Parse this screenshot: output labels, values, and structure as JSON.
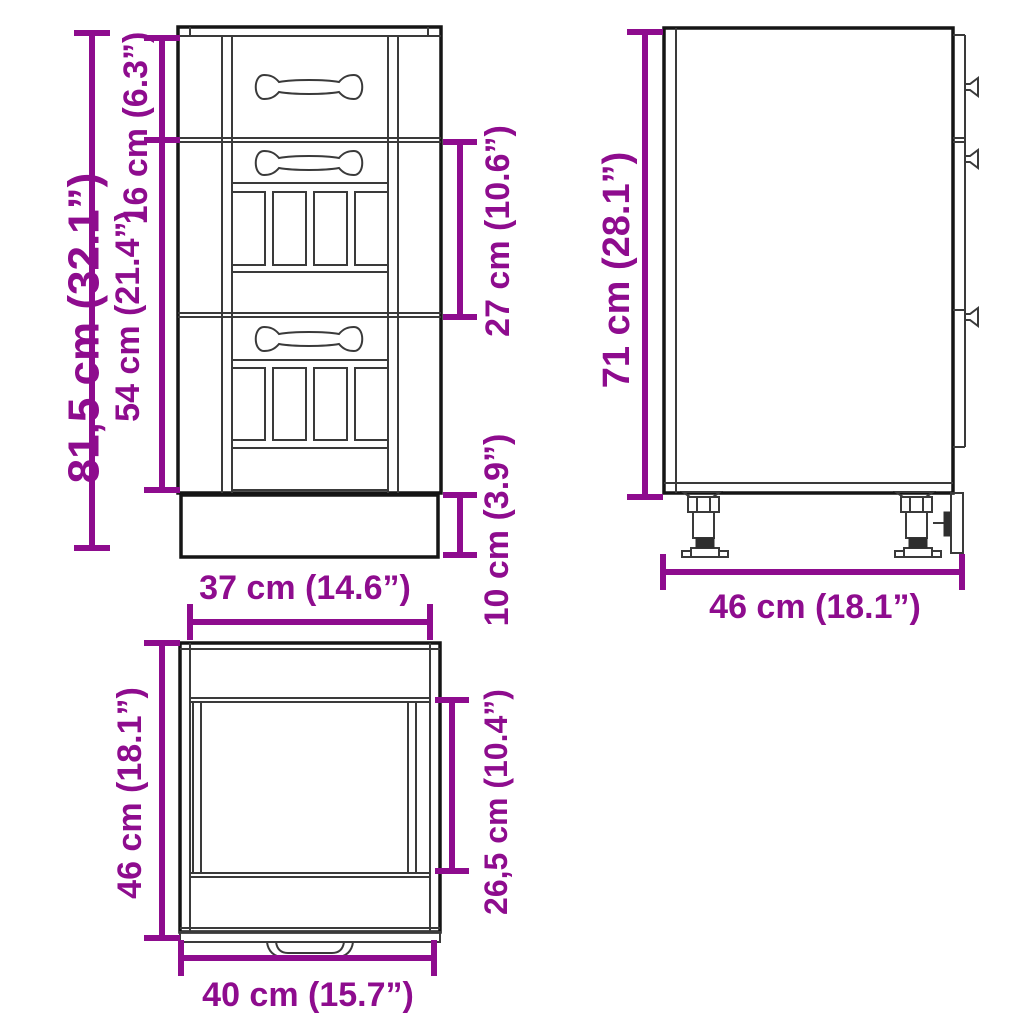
{
  "diagram": {
    "kind": "furniture-dimension-drawing",
    "subject": "kitchen base cabinet with drawers",
    "background_color": "#FFFFFF",
    "dimension_color": "#8E0C8E",
    "line_color": "#151515",
    "views": {
      "front": {
        "dimensions": {
          "total_height": {
            "label": "81,5 cm (32.1”)",
            "value_cm": "81,5",
            "value_in": "32.1"
          },
          "top_drawer_height": {
            "label": "16 cm (6.3”)",
            "value_cm": "16",
            "value_in": "6.3"
          },
          "lower_front_height": {
            "label": "54 cm (21.4”)",
            "value_cm": "54",
            "value_in": "21.4"
          },
          "middle_drawer_height": {
            "label": "27 cm (10.6”)",
            "value_cm": "27",
            "value_in": "10.6"
          },
          "plinth_height": {
            "label": "10 cm (3.9”)",
            "value_cm": "10",
            "value_in": "3.9"
          },
          "width": {
            "label": "37 cm (14.6”)",
            "value_cm": "37",
            "value_in": "14.6"
          }
        }
      },
      "side": {
        "dimensions": {
          "body_height": {
            "label": "71 cm (28.1”)",
            "value_cm": "71",
            "value_in": "28.1"
          },
          "depth": {
            "label": "46 cm (18.1”)",
            "value_cm": "46",
            "value_in": "18.1"
          }
        }
      },
      "top": {
        "dimensions": {
          "depth": {
            "label": "46 cm (18.1”)",
            "value_cm": "46",
            "value_in": "18.1"
          },
          "inner_depth": {
            "label": "26,5 cm (10.4”)",
            "value_cm": "26,5",
            "value_in": "10.4"
          },
          "width": {
            "label": "40 cm (15.7”)",
            "value_cm": "40",
            "value_in": "15.7"
          }
        }
      }
    }
  }
}
